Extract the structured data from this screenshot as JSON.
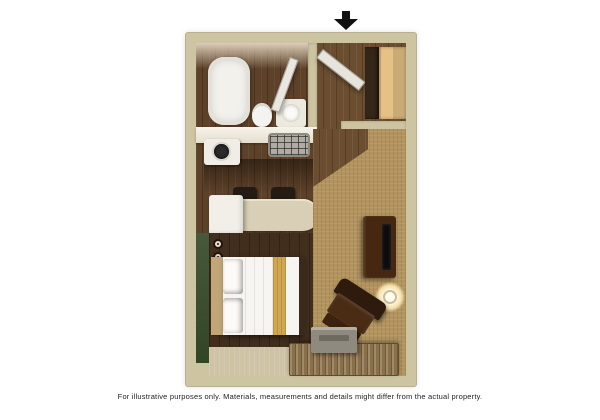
{
  "page": {
    "background_color": "#ffffff",
    "disclaimer": "For illustrative purposes only.  Materials, measurements and details might differ from the actual property."
  },
  "floor_plan": {
    "kind": "studio-suite-3d-floor-plan",
    "entrance": {
      "marker": "black-down-arrow",
      "location": "top, above entry door"
    },
    "colors": {
      "outer_wall": "#cdc4a1",
      "wood_floor": "#5d4129",
      "bedroom_floor": "#412e1d",
      "carpet_gold": "#b3945f",
      "carpet_light": "#cfc3a6",
      "accent_wall_green": "#3e5030",
      "closet_door": "#e6c185",
      "counter_white": "#f0ede4",
      "bar_beige": "#d8cfb6",
      "furniture_dark_wood": "#45280f",
      "bed_linen": "#f6f5f1",
      "bed_runner_gold": "#d2a64e"
    },
    "rooms": [
      {
        "name": "bathroom",
        "position": "top-left",
        "fixtures": [
          "bathtub",
          "toilet",
          "vanity-sink",
          "open-door"
        ]
      },
      {
        "name": "entry",
        "position": "top-right",
        "fixtures": [
          "open-entry-door",
          "closet"
        ]
      },
      {
        "name": "kitchen",
        "position": "middle-left",
        "fixtures": [
          "countertop",
          "cooktop",
          "sink-unit",
          "stool",
          "stool",
          "breakfast-bar",
          "refrigerator"
        ]
      },
      {
        "name": "sleeping-area",
        "position": "bottom-left",
        "fixtures": [
          "green-accent-wall",
          "queen-bed",
          "pillows",
          "gold-bed-runner",
          "wall-lights"
        ]
      },
      {
        "name": "living-area",
        "position": "right",
        "fixtures": [
          "tv-stand-with-tv",
          "armchair",
          "side-table-with-lamp",
          "dresser-console",
          "tv-on-console"
        ]
      }
    ]
  }
}
